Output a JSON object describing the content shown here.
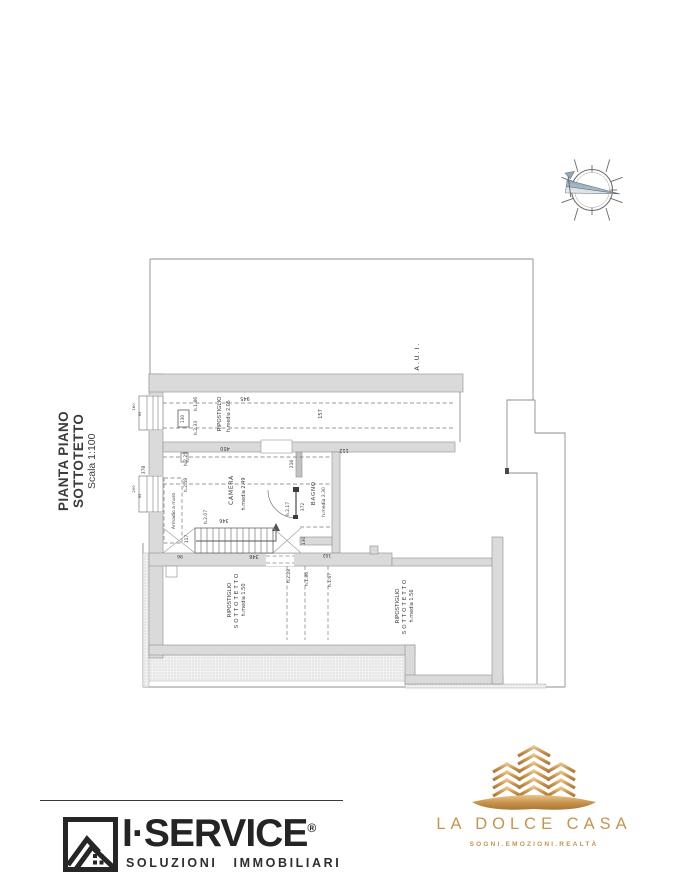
{
  "title_block": {
    "title": "PIANTA PIANO SOTTOTETTO",
    "scale": "Scala 1:100"
  },
  "plan": {
    "area_label": "A.U.I.",
    "rooms": {
      "ripostiglio": {
        "name": "RIPOSTIGLIO",
        "height": "h.media 2.05"
      },
      "camera": {
        "name": "CAMERA",
        "height": "h.media 2.49"
      },
      "bagno": {
        "name": "BAGNO",
        "height": "h.media 2.30"
      },
      "sottotetto_left": {
        "line1": "RIPOSTIGLIO",
        "line2": "SOTTOTETTO",
        "height": "h.media 1.50"
      },
      "sottotetto_right": {
        "line1": "RIPOSTIGLIO",
        "line2": "SOTTOTETTO",
        "height": "h.media 1.56"
      }
    },
    "annotations": {
      "armadio": "Armadio a muro",
      "h186_rip": "h.1.86",
      "h233": "h.2.33",
      "h225": "h.2.25",
      "h258": "h.2.58",
      "h207": "h.2.07",
      "h217": "h.2.17",
      "h228": "h.2.28",
      "h186_sott": "h.1.86",
      "h167": "h.1.67"
    },
    "dimensions": {
      "d945": "945",
      "d157": "157",
      "d450": "450",
      "d112": "112",
      "d216": "216",
      "d346_top": "346",
      "d346_stairs": "346",
      "d372": "372",
      "d130_box": "130",
      "d130_stairs": "130",
      "d102": "102",
      "d117": "117",
      "d96": "96",
      "d378": "378",
      "win1_w": "160",
      "win1_h": "95",
      "win2_w": "200",
      "win2_h": "95"
    }
  },
  "footer": {
    "iservice": {
      "brand": "I·SERVICE",
      "registered": "®",
      "tagline": "SOLUZIONI IMMOBILIARI"
    },
    "dolcecasa": {
      "brand": "LA DOLCE CASA",
      "tagline": "SOGNI.EMOZIONI.REALTÀ"
    }
  },
  "colors": {
    "gold": "#c6944e",
    "ink": "#2b2b2b",
    "wall_fill": "#dadada",
    "wall_stroke": "#9a9a9a",
    "thin_line": "#8f8f8f"
  }
}
